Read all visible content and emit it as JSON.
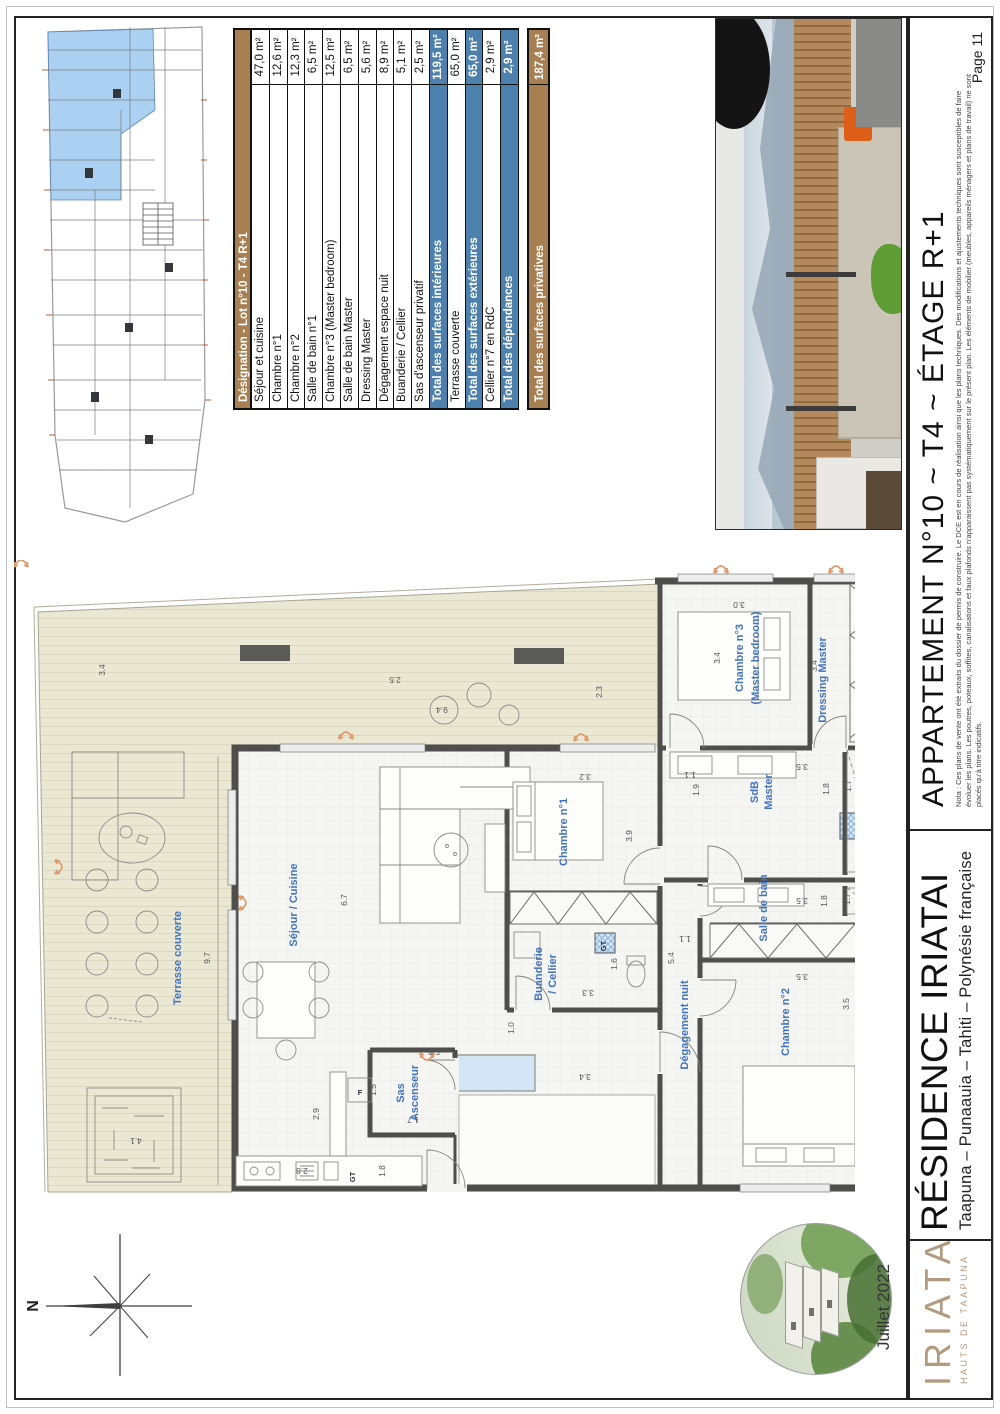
{
  "page": {
    "number_label": "Page 11",
    "date": "Juillet 2022"
  },
  "title_block": {
    "apartment_title": "APPARTEMENT N°10 ~ T4 ~ ÉTAGE R+1",
    "residence_name": "RÉSIDENCE IRIATAI",
    "residence_location": "Taapuna – Punaauia – Tahiti – Polynésie française",
    "logo_name": "IRIATAI",
    "logo_subtitle": "HAUTS DE TAAPUNA",
    "nota_line1": "Nota : Ces plans de vente ont été extraits du dossier de permis de construire. Le DCE est en cours de réalisation ainsi que les plans techniques. Des modifications et ajustements techniques sont susceptibles de faire",
    "nota_line2": "évoluer les plans. Les poutres, poteaux, soffites, canalisations et faux plafonds n'apparaissent pas systématiquement sur le présent plan. Les éléments de mobilier (meubles, appareils ménagers et plans de travail) ne sont",
    "nota_line3": "placés qu'à titre indicatifs."
  },
  "surface_table": {
    "header": "Désignation - Lot n°10 - T4 R+1",
    "rows": [
      {
        "label": "Séjour et cuisine",
        "value": "47,0 m²",
        "s": "n"
      },
      {
        "label": "Chambre n°1",
        "value": "12,6 m²",
        "s": "n"
      },
      {
        "label": "Chambre n°2",
        "value": "12,3 m²",
        "s": "n"
      },
      {
        "label": "Salle de bain n°1",
        "value": "6,5 m²",
        "s": "n"
      },
      {
        "label": "Chambre n°3 (Master bedroom)",
        "value": "12,5 m²",
        "s": "n"
      },
      {
        "label": "Salle de bain Master",
        "value": "6,5 m²",
        "s": "n"
      },
      {
        "label": "Dressing Master",
        "value": "5,6 m²",
        "s": "n"
      },
      {
        "label": "Dégagement espace nuit",
        "value": "8,9 m²",
        "s": "n"
      },
      {
        "label": "Buanderie / Cellier",
        "value": "5,1 m²",
        "s": "n"
      },
      {
        "label": "Sas d'ascenseur privatif",
        "value": "2,5 m²",
        "s": "n"
      },
      {
        "label": "Total des surfaces intérieures",
        "value": "119,5 m²",
        "s": "t"
      },
      {
        "label": "Terrasse couverte",
        "value": "65,0 m²",
        "s": "n"
      },
      {
        "label": "Total des surfaces extérieures",
        "value": "65,0 m²",
        "s": "t"
      },
      {
        "label": "Cellier n°7 en RdC",
        "value": "2,9 m²",
        "s": "n"
      },
      {
        "label": "Total des dépendances",
        "value": "2,9 m²",
        "s": "t"
      },
      {
        "s": "gap"
      },
      {
        "label": "Total des surfaces privatives",
        "value": "187,4 m²",
        "s": "g"
      }
    ]
  },
  "floor_plan": {
    "north_label": "N",
    "labels": [
      {
        "t": "Séjour / Cuisine",
        "x": 283,
        "y": 345,
        "r": -90
      },
      {
        "t": "Chambre n°1",
        "x": 553,
        "y": 272,
        "r": -90
      },
      {
        "t": "Buanderie",
        "x": 528,
        "y": 414,
        "r": -90
      },
      {
        "t": "/ Cellier",
        "x": 542,
        "y": 414,
        "r": -90
      },
      {
        "t": "Sas",
        "x": 390,
        "y": 533,
        "r": -90
      },
      {
        "t": "Ascenseur",
        "x": 404,
        "y": 533,
        "r": -90
      },
      {
        "t": "Chambre n°3",
        "x": 729,
        "y": 98,
        "r": -90
      },
      {
        "t": "(Master bedroom)",
        "x": 745,
        "y": 98,
        "r": -90
      },
      {
        "t": "Dressing Master",
        "x": 812,
        "y": 120,
        "r": -90
      },
      {
        "t": "SdB",
        "x": 744,
        "y": 232,
        "r": -90
      },
      {
        "t": "Master",
        "x": 758,
        "y": 232,
        "r": -90
      },
      {
        "t": "Salle de bain",
        "x": 753,
        "y": 348,
        "r": -90
      },
      {
        "t": "Dégagement nuit",
        "x": 674,
        "y": 465,
        "r": -90
      },
      {
        "t": "Chambre n°2",
        "x": 775,
        "y": 462,
        "r": -90
      },
      {
        "t": "Terrasse couverte",
        "x": 167,
        "y": 398,
        "r": -90
      }
    ],
    "dimensions": [
      {
        "t": "3.4",
        "x": 91,
        "y": 110,
        "r": -90
      },
      {
        "t": "2.5",
        "x": 381,
        "y": 117,
        "r": 180
      },
      {
        "t": "9.4",
        "x": 428,
        "y": 147,
        "r": 180
      },
      {
        "t": "2.3",
        "x": 588,
        "y": 132,
        "r": -90
      },
      {
        "t": "9.7",
        "x": 196,
        "y": 398,
        "r": -90
      },
      {
        "t": "4.1",
        "x": 122,
        "y": 578,
        "r": 180
      },
      {
        "t": "3.4",
        "x": 571,
        "y": 514,
        "r": 180
      },
      {
        "t": "6.7",
        "x": 333,
        "y": 340,
        "r": -90
      },
      {
        "t": "5.8",
        "x": 420,
        "y": 489,
        "r": 180
      },
      {
        "t": "2.8",
        "x": 288,
        "y": 608,
        "r": 180
      },
      {
        "t": "2.9",
        "x": 305,
        "y": 554,
        "r": -90
      },
      {
        "t": "1.0",
        "x": 500,
        "y": 468,
        "r": -90
      },
      {
        "t": "1.5",
        "x": 362,
        "y": 530,
        "r": -90
      },
      {
        "t": "1.7",
        "x": 399,
        "y": 557,
        "r": 180
      },
      {
        "t": "1.8",
        "x": 371,
        "y": 611,
        "r": -90
      },
      {
        "t": "3.2",
        "x": 571,
        "y": 214,
        "r": 180
      },
      {
        "t": "3.9",
        "x": 618,
        "y": 276,
        "r": -90
      },
      {
        "t": "1.6",
        "x": 603,
        "y": 404,
        "r": -90
      },
      {
        "t": "3.3",
        "x": 574,
        "y": 430,
        "r": 180
      },
      {
        "t": "3.0",
        "x": 725,
        "y": 42,
        "r": 180
      },
      {
        "t": "3.4",
        "x": 706,
        "y": 98,
        "r": -90
      },
      {
        "t": "3.4",
        "x": 803,
        "y": 106,
        "r": -90
      },
      {
        "t": "1.6",
        "x": 855,
        "y": 60,
        "r": 180
      },
      {
        "t": "1.1",
        "x": 676,
        "y": 212,
        "r": 180
      },
      {
        "t": "1.9",
        "x": 685,
        "y": 230,
        "r": -90
      },
      {
        "t": "3.5",
        "x": 788,
        "y": 204,
        "r": 180
      },
      {
        "t": "1.8",
        "x": 815,
        "y": 229,
        "r": -90
      },
      {
        "t": "1.7",
        "x": 837,
        "y": 226,
        "r": -90
      },
      {
        "t": "3.5",
        "x": 788,
        "y": 338,
        "r": 180
      },
      {
        "t": "1.8",
        "x": 813,
        "y": 341,
        "r": -90
      },
      {
        "t": "1.7",
        "x": 836,
        "y": 339,
        "r": -90
      },
      {
        "t": "5.4",
        "x": 660,
        "y": 398,
        "r": -90
      },
      {
        "t": "1.1",
        "x": 671,
        "y": 376,
        "r": 180
      },
      {
        "t": "3.5",
        "x": 788,
        "y": 414,
        "r": 180
      },
      {
        "t": "3.5",
        "x": 835,
        "y": 444,
        "r": -90
      }
    ],
    "tags": [
      {
        "t": "GT",
        "x": 341,
        "y": 617,
        "r": -90
      },
      {
        "t": "GT",
        "x": 592,
        "y": 386,
        "r": -90
      },
      {
        "t": "GT",
        "x": 847,
        "y": 269,
        "r": -90
      },
      {
        "t": "F",
        "x": 346,
        "y": 535,
        "r": 0
      }
    ]
  },
  "colors": {
    "table_header_brown": "#a87f52",
    "table_total_blue": "#4e80ad",
    "room_label_blue": "#4273bf",
    "terrace_beige": "#eae8d3",
    "wall_gray": "#4e4e4c",
    "arrow_orange": "#df9a6d",
    "elevator_blue": "#d3e4f4",
    "site_highlight_blue": "#abd0f2",
    "logo_tan": "#b29a7e"
  }
}
